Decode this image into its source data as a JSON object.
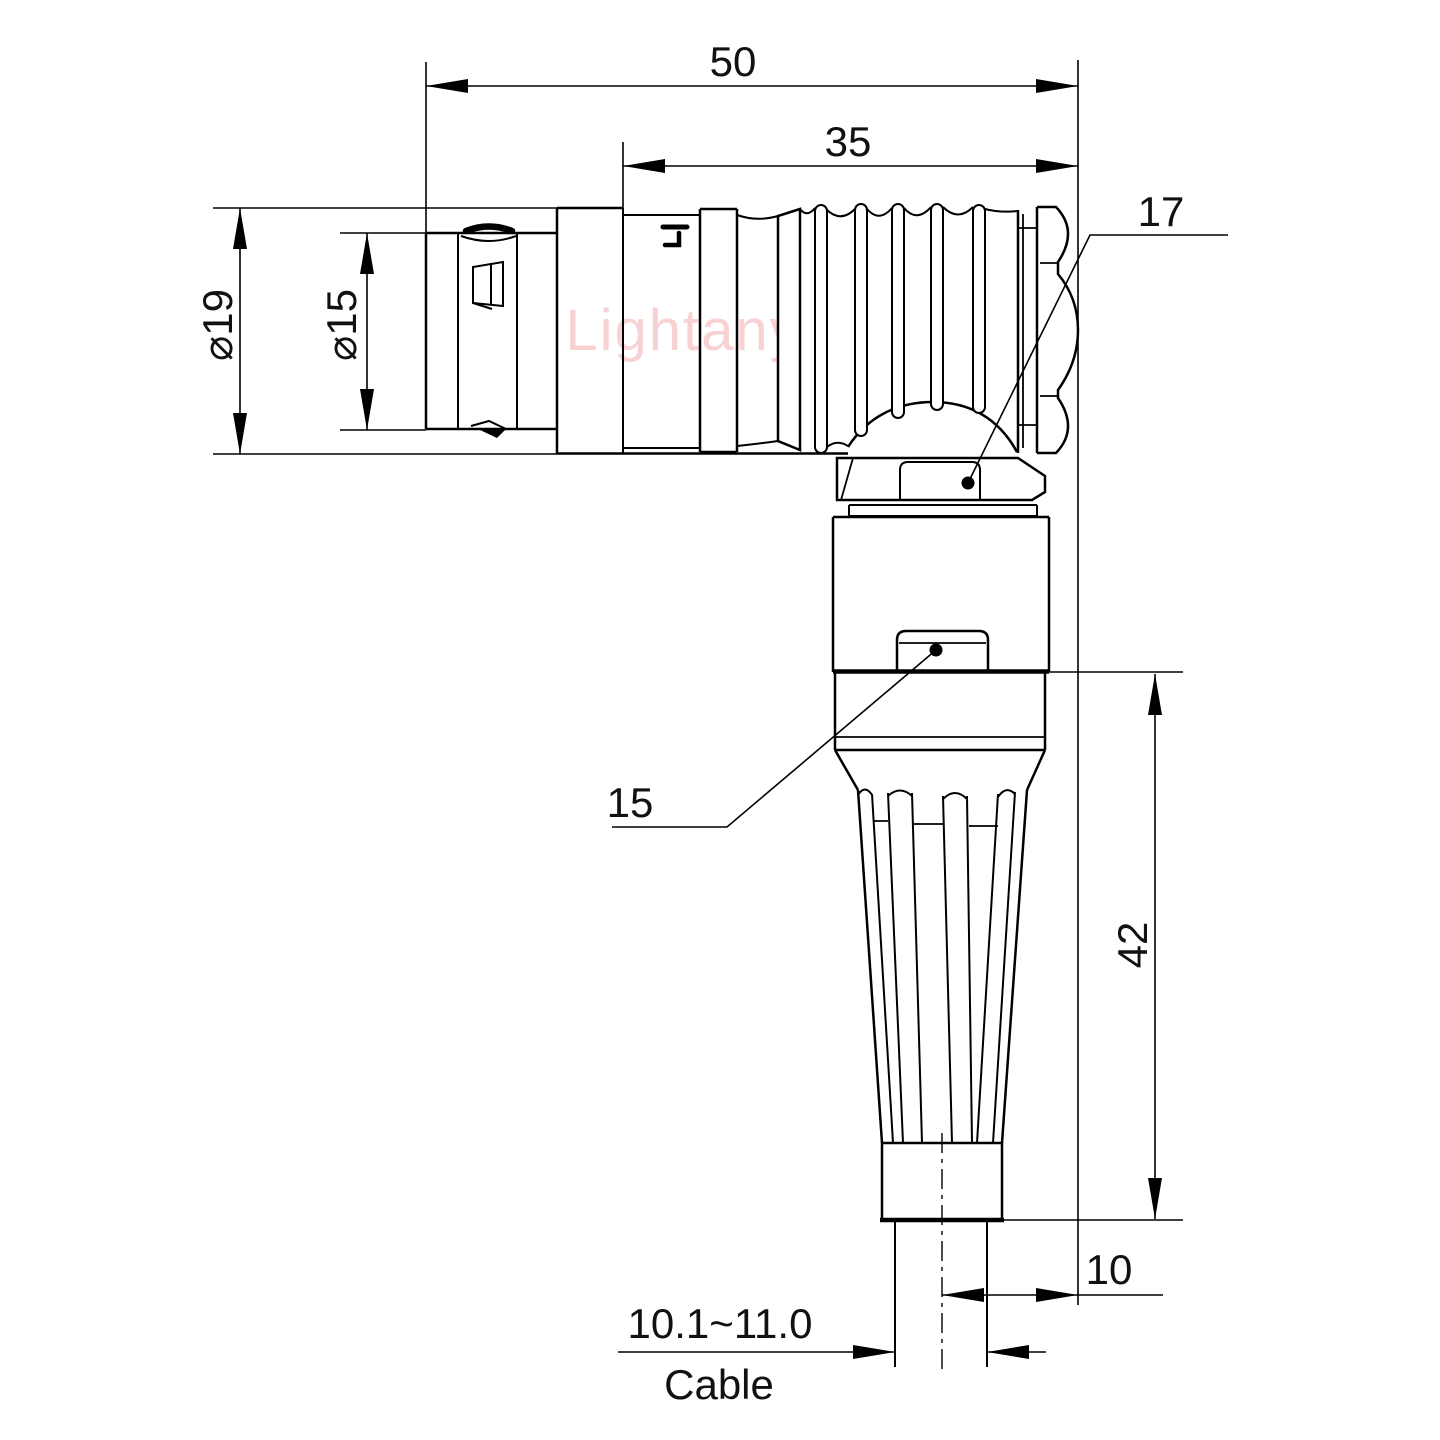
{
  "drawing": {
    "watermark": "Lightany",
    "labels": {
      "dim_overall_length": "50",
      "dim_body_length": "35",
      "dia_outer": "⌀19",
      "dia_inner": "⌀15",
      "callout_nut_flat": "17",
      "callout_body_flat": "15",
      "dim_height": "42",
      "dim_cable_offset": "10",
      "cable_diameter_range": "10.1~11.0",
      "cable_label": "Cable"
    },
    "colors": {
      "line": "#000000",
      "watermark": "#f8d2d2",
      "background": "#ffffff"
    }
  }
}
